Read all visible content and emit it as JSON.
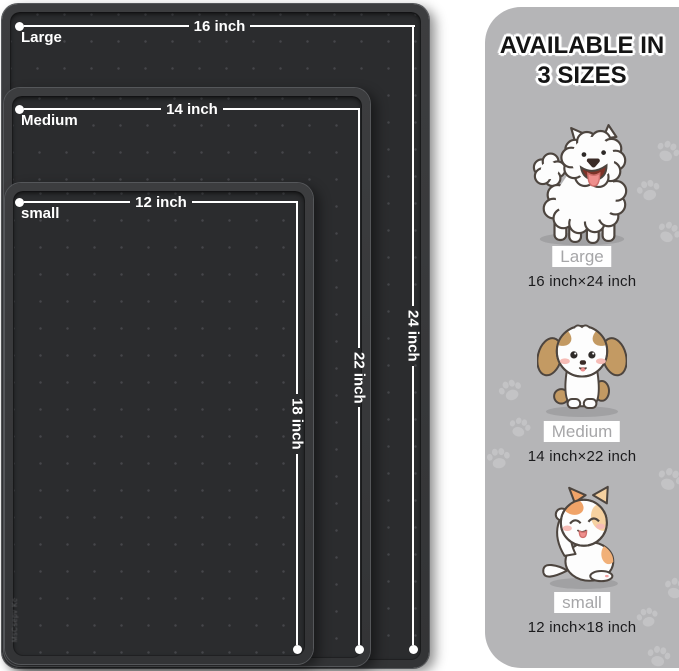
{
  "mats": [
    {
      "name": "Large",
      "width_label": "16 inch",
      "height_label": "24 inch"
    },
    {
      "name": "Medium",
      "width_label": "14 inch",
      "height_label": "22 inch"
    },
    {
      "name": "small",
      "width_label": "12 inch",
      "height_label": "18 inch"
    }
  ],
  "watermark": "MsCsepv Kc",
  "panel": {
    "title_line1": "AVAILABLE IN",
    "title_line2": "3 SIZES",
    "sizes": [
      {
        "animal": "samoyed-dog",
        "label": "Large",
        "dimensions": "16 inch×24 inch"
      },
      {
        "animal": "shih-tzu-puppy",
        "label": "Medium",
        "dimensions": "14 inch×22 inch"
      },
      {
        "animal": "cat",
        "label": "small",
        "dimensions": "12 inch×18 inch"
      }
    ]
  },
  "colors": {
    "mat_rim": "#38393b",
    "mat_surface": "#2b2c2e",
    "panel_bg": "#b5b5b7",
    "dimension_line": "#ffffff",
    "label_box_bg": "#ffffff",
    "label_text": "#a6a6a8",
    "paw_print": "#c3c3c5"
  }
}
